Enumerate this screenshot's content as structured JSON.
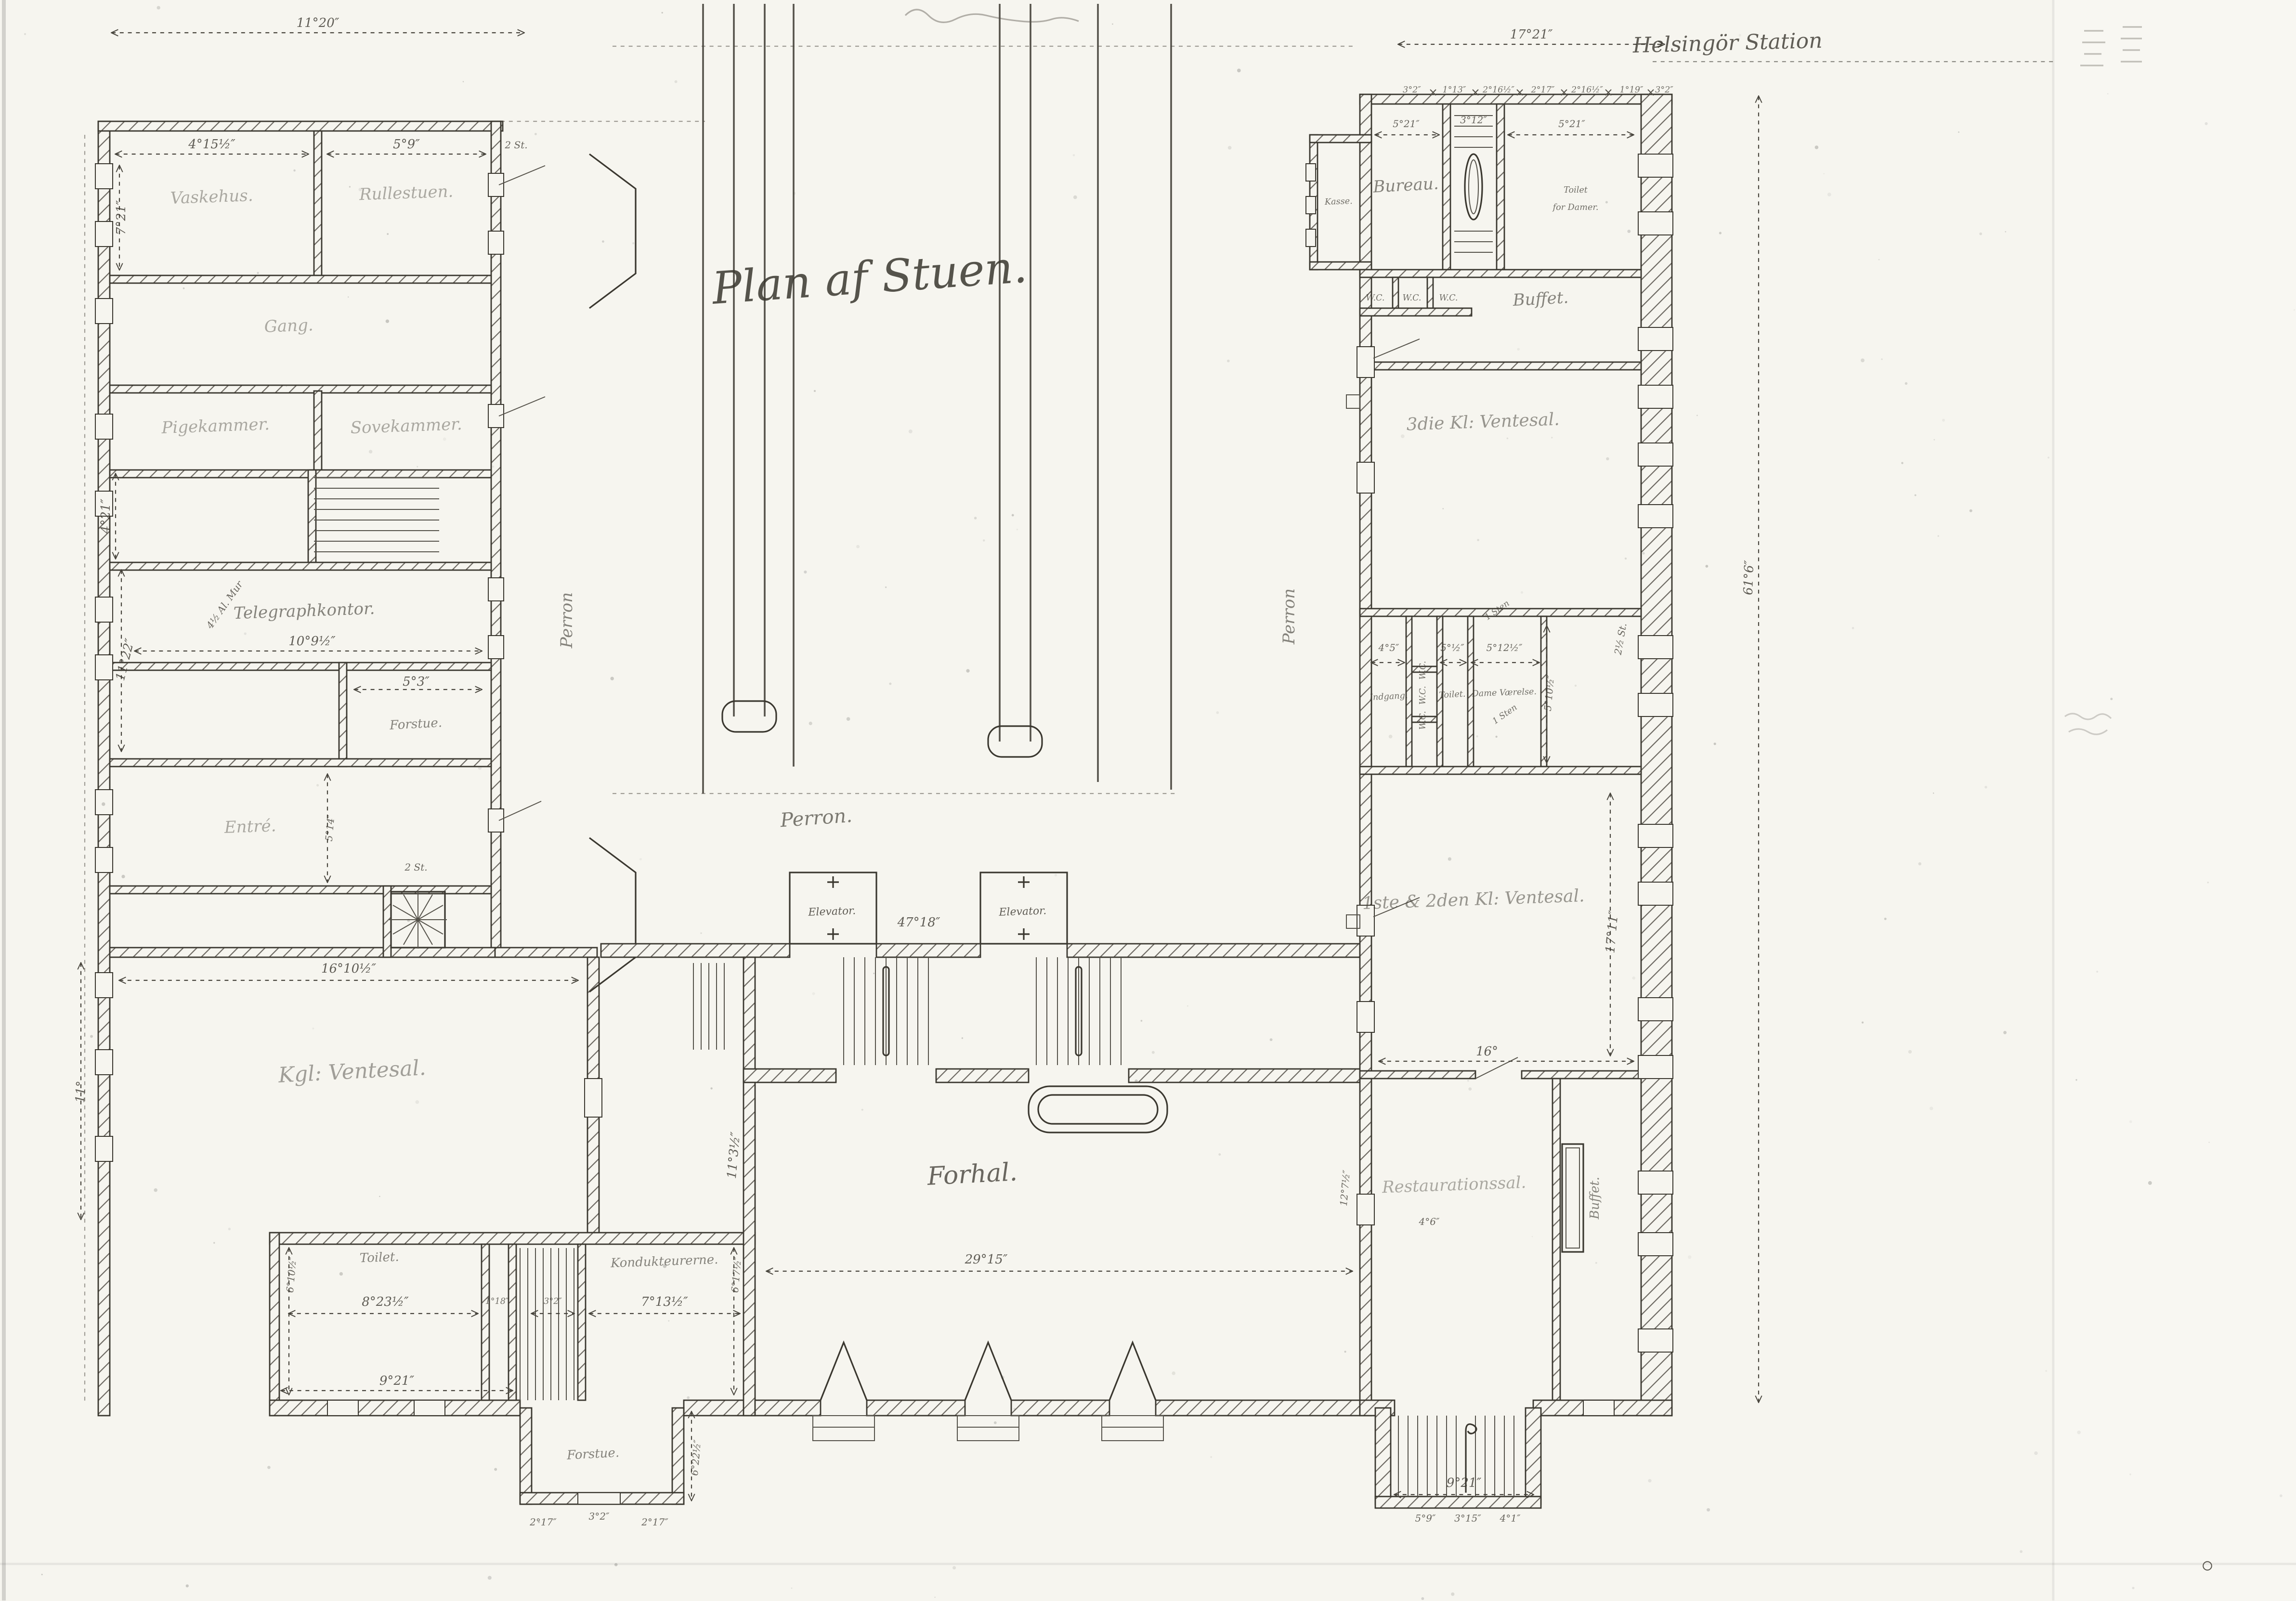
{
  "sheet": {
    "kind": "scanned hand-drawn floor plan",
    "floor_title": "Plan af Stuen.",
    "station_name": "Helsingör Station",
    "paper_color": "#f6f5ef",
    "ink_color": "#3a372f"
  },
  "texts": {
    "title": "Plan af Stuen.",
    "station": "Helsingör Station",
    "perron_main": "Perron.",
    "perron_west": "Perron",
    "perron_east": "Perron",
    "elevator1": "Elevator.",
    "elevator2": "Elevator.",
    "dim_47_18": "47°18″",
    "forhal": "Forhal.",
    "dim_29_15": "29°15″",
    "dim_11_3": "11°3½″",
    "dim_12_7": "12°7½″",
    "lw_width": "11°20″",
    "lw_room_a": "Vaskehus.",
    "lw_room_a_dim": "4°15½″",
    "lw_room_b": "Rullestuen.",
    "lw_room_b_dim": "5°9″",
    "lw_note_2st_top": "2 St.",
    "lw_dim_7_21": "7°21″",
    "lw_gang": "Gang.",
    "lw_room_c": "Pigekammer.",
    "lw_room_d": "Sovekammer.",
    "lw_dim_4_21": "4°21″",
    "lw_telegraph": "Telegraphkontor.",
    "lw_dim_10_9": "10°9½″",
    "lw_dim_11_22": "11°22″",
    "lw_forstue": "Forstue.",
    "lw_dim_5_3": "5°3″",
    "lw_entre": "Entré.",
    "lw_dim_5_14": "5°14″",
    "lw_note_2st": "2 St.",
    "lw_wall_note": "4½ Al. Mur",
    "lw_royal": "Kgl: Ventesal.",
    "lw_dim_16_10": "16°10½″",
    "lw_dim_11": "11°",
    "sw_toilet": "Toilet.",
    "sw_dim_8_23": "8°23½″",
    "sw_dim_6_10": "6°10½″",
    "sw_dim_1_18": "1°18″",
    "sw_dim_3_2": "3°2″",
    "sw_room": "Kondukteurerne.",
    "sw_dim_7_13": "7°13½″",
    "sw_dim_6_17": "6°17½″",
    "sw_dim_9_21": "9°21″",
    "sw_forstue": "Forstue.",
    "sw_dim_6_22": "6°22½″",
    "sw_dim_b1": "2°17″",
    "sw_dim_b2": "3°2″",
    "sw_dim_b3": "2°17″",
    "rw_width": "17°21″",
    "rw_sub1": "3°2″",
    "rw_sub2": "1°13″",
    "rw_sub3": "2°16½″",
    "rw_sub4": "2°17″",
    "rw_sub5": "2°16½″",
    "rw_sub6": "1°19″",
    "rw_sub7": "3°2″",
    "rw_kasse": "Kasse.",
    "rw_bureau": "Bureau.",
    "rw_dim_5_21a": "5°21″",
    "rw_stair_dim": "3°12″",
    "rw_dim_5_21b": "5°21″",
    "rw_toilet_damer1": "Toilet",
    "rw_toilet_damer2": "for Damer.",
    "rw_wc1": "W.C.",
    "rw_wc2": "W.C.",
    "rw_wc3": "W.C.",
    "rw_buffet_room": "Buffet.",
    "rw_wait3": "3die Kl: Ventesal.",
    "rw_indgang": "Indgang.",
    "rw_dim_4_5": "4°5″",
    "rw_wc_v1": "W.C.",
    "rw_wc_v2": "W.C.",
    "rw_wc_v3": "W.C.",
    "rw_toilet": "Toilet.",
    "rw_dim_5_05": "5°½″",
    "rw_dame": "Dame Værelse.",
    "rw_dim_5_12": "5°12½″",
    "rw_dim_5_10": "5°10½″",
    "rw_1sten_a": "1 Sten",
    "rw_1sten_b": "1 Sten",
    "rw_25st": "2½ St.",
    "rw_wait12": "1ste & 2den Kl: Ventesal.",
    "rw_dim_16": "16°",
    "rw_dim_17_11": "17°11″",
    "rw_rest": "Restaurationssal.",
    "rw_dim_4_6": "4°6″",
    "rw_buffet": "Buffet.",
    "rw_dim_9_21": "9°21″",
    "rw_s1": "5°9″",
    "rw_s2": "3°15″",
    "rw_s3": "4°1″",
    "rw_dim_61_6": "61°6″"
  }
}
